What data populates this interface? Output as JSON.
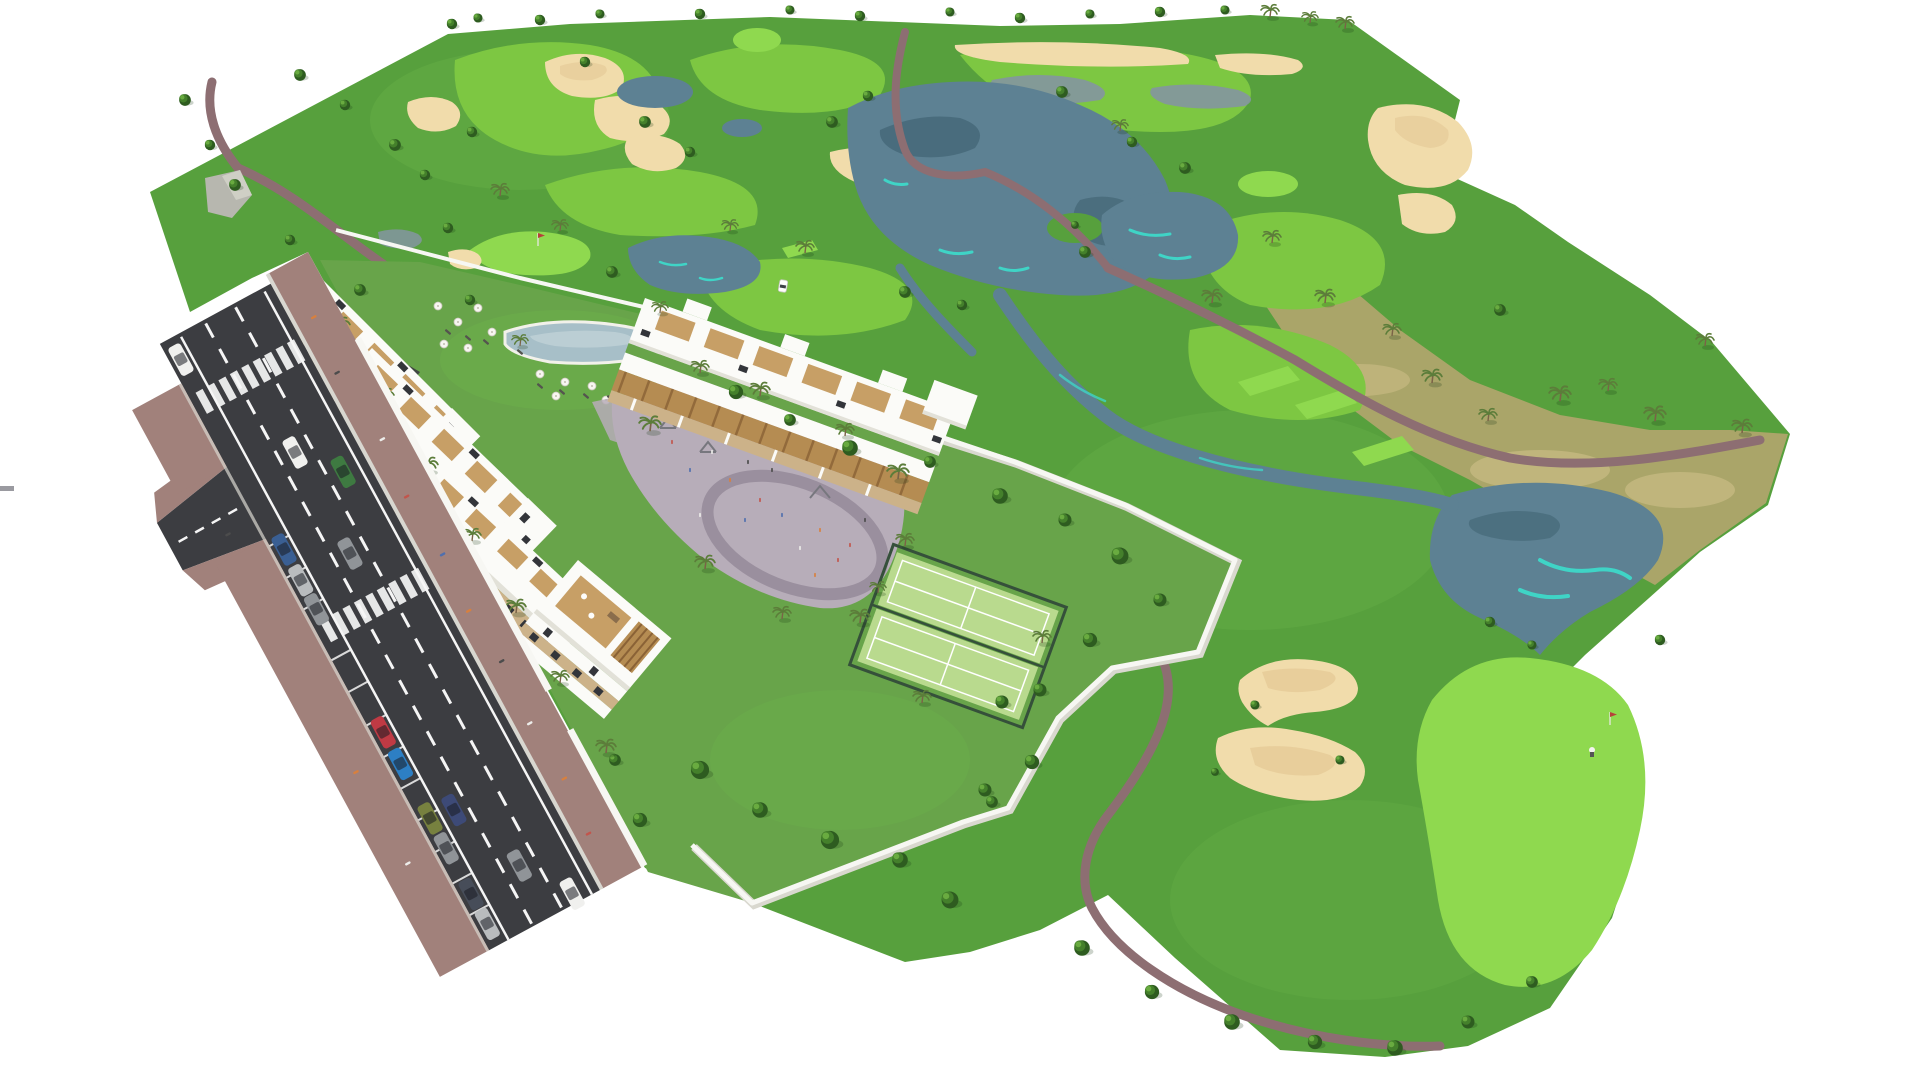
{
  "scene": {
    "kind": "aerial-3d-masterplan-rendering",
    "subject": "white-apartment-residences-beside-golf-course"
  },
  "colors": {
    "bg": "#ffffff",
    "rough": "#57a03d",
    "roughLight": "#6db54b",
    "fairway": "#7dc742",
    "green": "#8fd94f",
    "sand": "#f1dcab",
    "sandShadow": "#e2c491",
    "water": "#5d8193",
    "waterDeep": "#3c5f6e",
    "waterCyan": "#3fd4c6",
    "marsh": "#8495a1",
    "path": "#8d6e72",
    "scrub": "#aaa569",
    "scrubTan": "#d2c28c",
    "garden": "#68a44a",
    "hedge": "#3a6f2a",
    "treeDark": "#2e5c20",
    "treeMid": "#44802b",
    "treeLight": "#69ab40",
    "palmFrond": "#5c7d3a",
    "trunk": "#7a6347",
    "rock": "#b7b7af",
    "roadAsphalt": "#3c3d41",
    "roadLine": "#f5f5f5",
    "sidewalk": "#a1817b",
    "curb": "#d8d7d0",
    "wall": "#f7f7f3",
    "wallShade": "#d9d8cf",
    "bldgWhite": "#fbfbf8",
    "bldgShade": "#e2e1d8",
    "bldgTan": "#ccb289",
    "deck": "#c79f66",
    "pergola": "#b58c52",
    "pergSlat": "#8a6236",
    "windowDark": "#33353a",
    "plaza": "#b7adb9",
    "plazaPath": "#9a8f9e",
    "pool": "#a7bfc8",
    "poolLight": "#c3d4d9",
    "court": "#b9da8e",
    "courtLine": "#ffffff",
    "courtFence": "#35503a",
    "flag": "#b6413a",
    "carWhite": "#f0f0ee",
    "carBlue": "#3a5f93",
    "carBrightBlue": "#2d7fc4",
    "carRed": "#bf3a44",
    "carGreen": "#3e7a41",
    "carOlive": "#77813f",
    "carGray": "#909498",
    "carSilver": "#b9bcbe",
    "carDark": "#474d59",
    "carNavy": "#3d4a77",
    "peopleOrange": "#d8803e",
    "peopleWhite": "#ededea",
    "peopleDark": "#4c4c4c",
    "peopleRed": "#c2554c",
    "peopleBlue": "#4f6fae"
  }
}
